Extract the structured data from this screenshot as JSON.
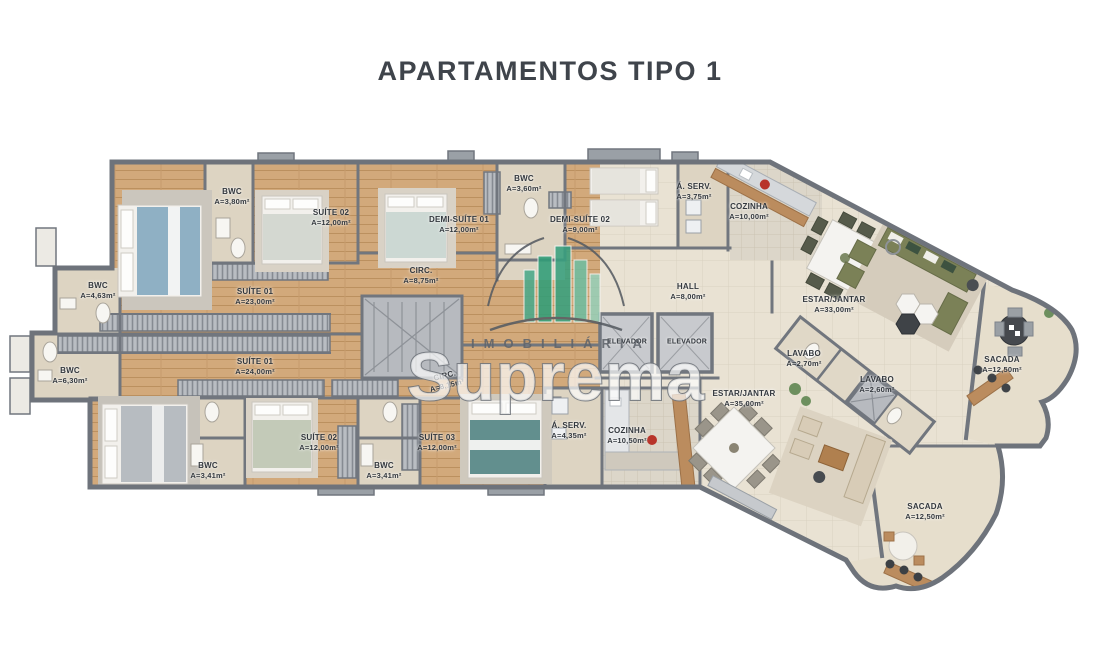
{
  "title": "APARTAMENTOS TIPO 1",
  "watermark": {
    "brand": "Suprema",
    "tagline": "IMOBILIÁRIA",
    "logo_color": "#2f9e78"
  },
  "palette": {
    "wood_floor": "#d2a97b",
    "tile_floor": "#e9e2d3",
    "bath_floor": "#ddd4c2",
    "wall": "#71767e",
    "label_text": "#33383e",
    "sofa_olive": "#7b8157",
    "sofa_beige": "#d8ccb7",
    "wood_counter": "#bb8c5e"
  },
  "rooms": [
    {
      "unit": "superior",
      "name": "SUÍTE 01",
      "area": "A=23,00m²",
      "x": 255,
      "y": 297
    },
    {
      "unit": "superior",
      "name": "BWC",
      "area": "A=3,80m²",
      "x": 232,
      "y": 197
    },
    {
      "unit": "superior",
      "name": "SUÍTE 02",
      "area": "A=12,00m²",
      "x": 331,
      "y": 218
    },
    {
      "unit": "superior",
      "name": "DEMI-SUÍTE 01",
      "area": "A=12,00m²",
      "x": 459,
      "y": 225
    },
    {
      "unit": "superior",
      "name": "BWC",
      "area": "A=3,60m²",
      "x": 524,
      "y": 184
    },
    {
      "unit": "superior",
      "name": "DEMI-SUÍTE 02",
      "area": "A=9,00m²",
      "x": 580,
      "y": 225
    },
    {
      "unit": "superior",
      "name": "Á. SERV.",
      "area": "A=3,75m²",
      "x": 694,
      "y": 192
    },
    {
      "unit": "superior",
      "name": "COZINHA",
      "area": "A=10,00m²",
      "x": 749,
      "y": 212
    },
    {
      "unit": "superior",
      "name": "CIRC.",
      "area": "A=8,75m²",
      "x": 421,
      "y": 276
    },
    {
      "unit": "superior",
      "name": "HALL",
      "area": "A=8,00m²",
      "x": 688,
      "y": 292
    },
    {
      "unit": "superior",
      "name": "ELEVADOR",
      "area": "",
      "x": 627,
      "y": 342,
      "small": true
    },
    {
      "unit": "superior",
      "name": "ELEVADOR",
      "area": "",
      "x": 687,
      "y": 342,
      "small": true
    },
    {
      "unit": "superior",
      "name": "ESTAR/JANTAR",
      "area": "A=33,00m²",
      "x": 834,
      "y": 305
    },
    {
      "unit": "superior",
      "name": "LAVABO",
      "area": "A=2,70m²",
      "x": 804,
      "y": 359
    },
    {
      "unit": "superior",
      "name": "SACADA",
      "area": "A=12,50m²",
      "x": 1002,
      "y": 365
    },
    {
      "unit": "inferior",
      "name": "BWC",
      "area": "A=4,63m²",
      "x": 98,
      "y": 291
    },
    {
      "unit": "inferior",
      "name": "BWC",
      "area": "A=6,30m²",
      "x": 70,
      "y": 376
    },
    {
      "unit": "inferior",
      "name": "SUÍTE 01",
      "area": "A=24,00m²",
      "x": 255,
      "y": 367
    },
    {
      "unit": "inferior",
      "name": "SUÍTE 02",
      "area": "A=12,00m²",
      "x": 319,
      "y": 443
    },
    {
      "unit": "inferior",
      "name": "BWC",
      "area": "A=3,41m²",
      "x": 208,
      "y": 471
    },
    {
      "unit": "inferior",
      "name": "SUÍTE 03",
      "area": "A=12,00m²",
      "x": 437,
      "y": 443
    },
    {
      "unit": "inferior",
      "name": "BWC",
      "area": "A=3,41m²",
      "x": 384,
      "y": 471
    },
    {
      "unit": "inferior",
      "name": "CIRC.",
      "area": "A=8,15m²",
      "x": 446,
      "y": 381,
      "rot": -14
    },
    {
      "unit": "inferior",
      "name": "Á. SERV.",
      "area": "A=4,35m²",
      "x": 569,
      "y": 431
    },
    {
      "unit": "inferior",
      "name": "COZINHA",
      "area": "A=10,50m²",
      "x": 627,
      "y": 436
    },
    {
      "unit": "inferior",
      "name": "ESTAR/JANTAR",
      "area": "A=35,00m²",
      "x": 744,
      "y": 399
    },
    {
      "unit": "inferior",
      "name": "LAVABO",
      "area": "A=2,60m²",
      "x": 877,
      "y": 385
    },
    {
      "unit": "inferior",
      "name": "SACADA",
      "area": "A=12,50m²",
      "x": 925,
      "y": 512
    }
  ]
}
